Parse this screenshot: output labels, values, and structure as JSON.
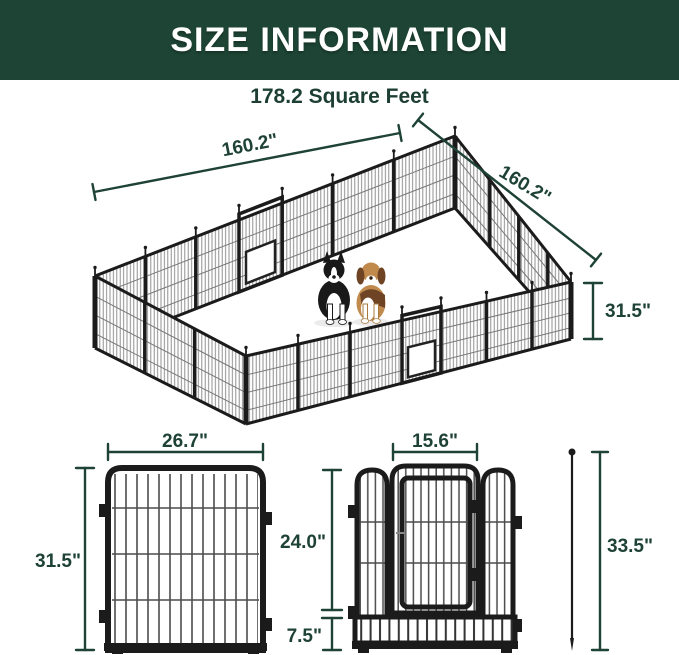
{
  "header": {
    "title": "SIZE INFORMATION"
  },
  "area_label": "178.2 Square Feet",
  "pen": {
    "side_left_label": "160.2\"",
    "side_right_label": "160.2\"",
    "height_label": "31.5\"",
    "illustrations": [
      "border-collie",
      "beagle"
    ]
  },
  "single_panel": {
    "width_label": "26.7\"",
    "height_label": "31.5\""
  },
  "gate_panel": {
    "door_width_label": "15.6\"",
    "door_height_label": "24.0\"",
    "bottom_height_label": "7.5\""
  },
  "stake": {
    "length_label": "33.5\""
  },
  "colors": {
    "header_bg": "#1d4434",
    "header_text": "#ffffff",
    "dimension_green": "#1e4236",
    "fence_frame": "#1b1b1b",
    "fence_wire": "#7d7d7d"
  }
}
